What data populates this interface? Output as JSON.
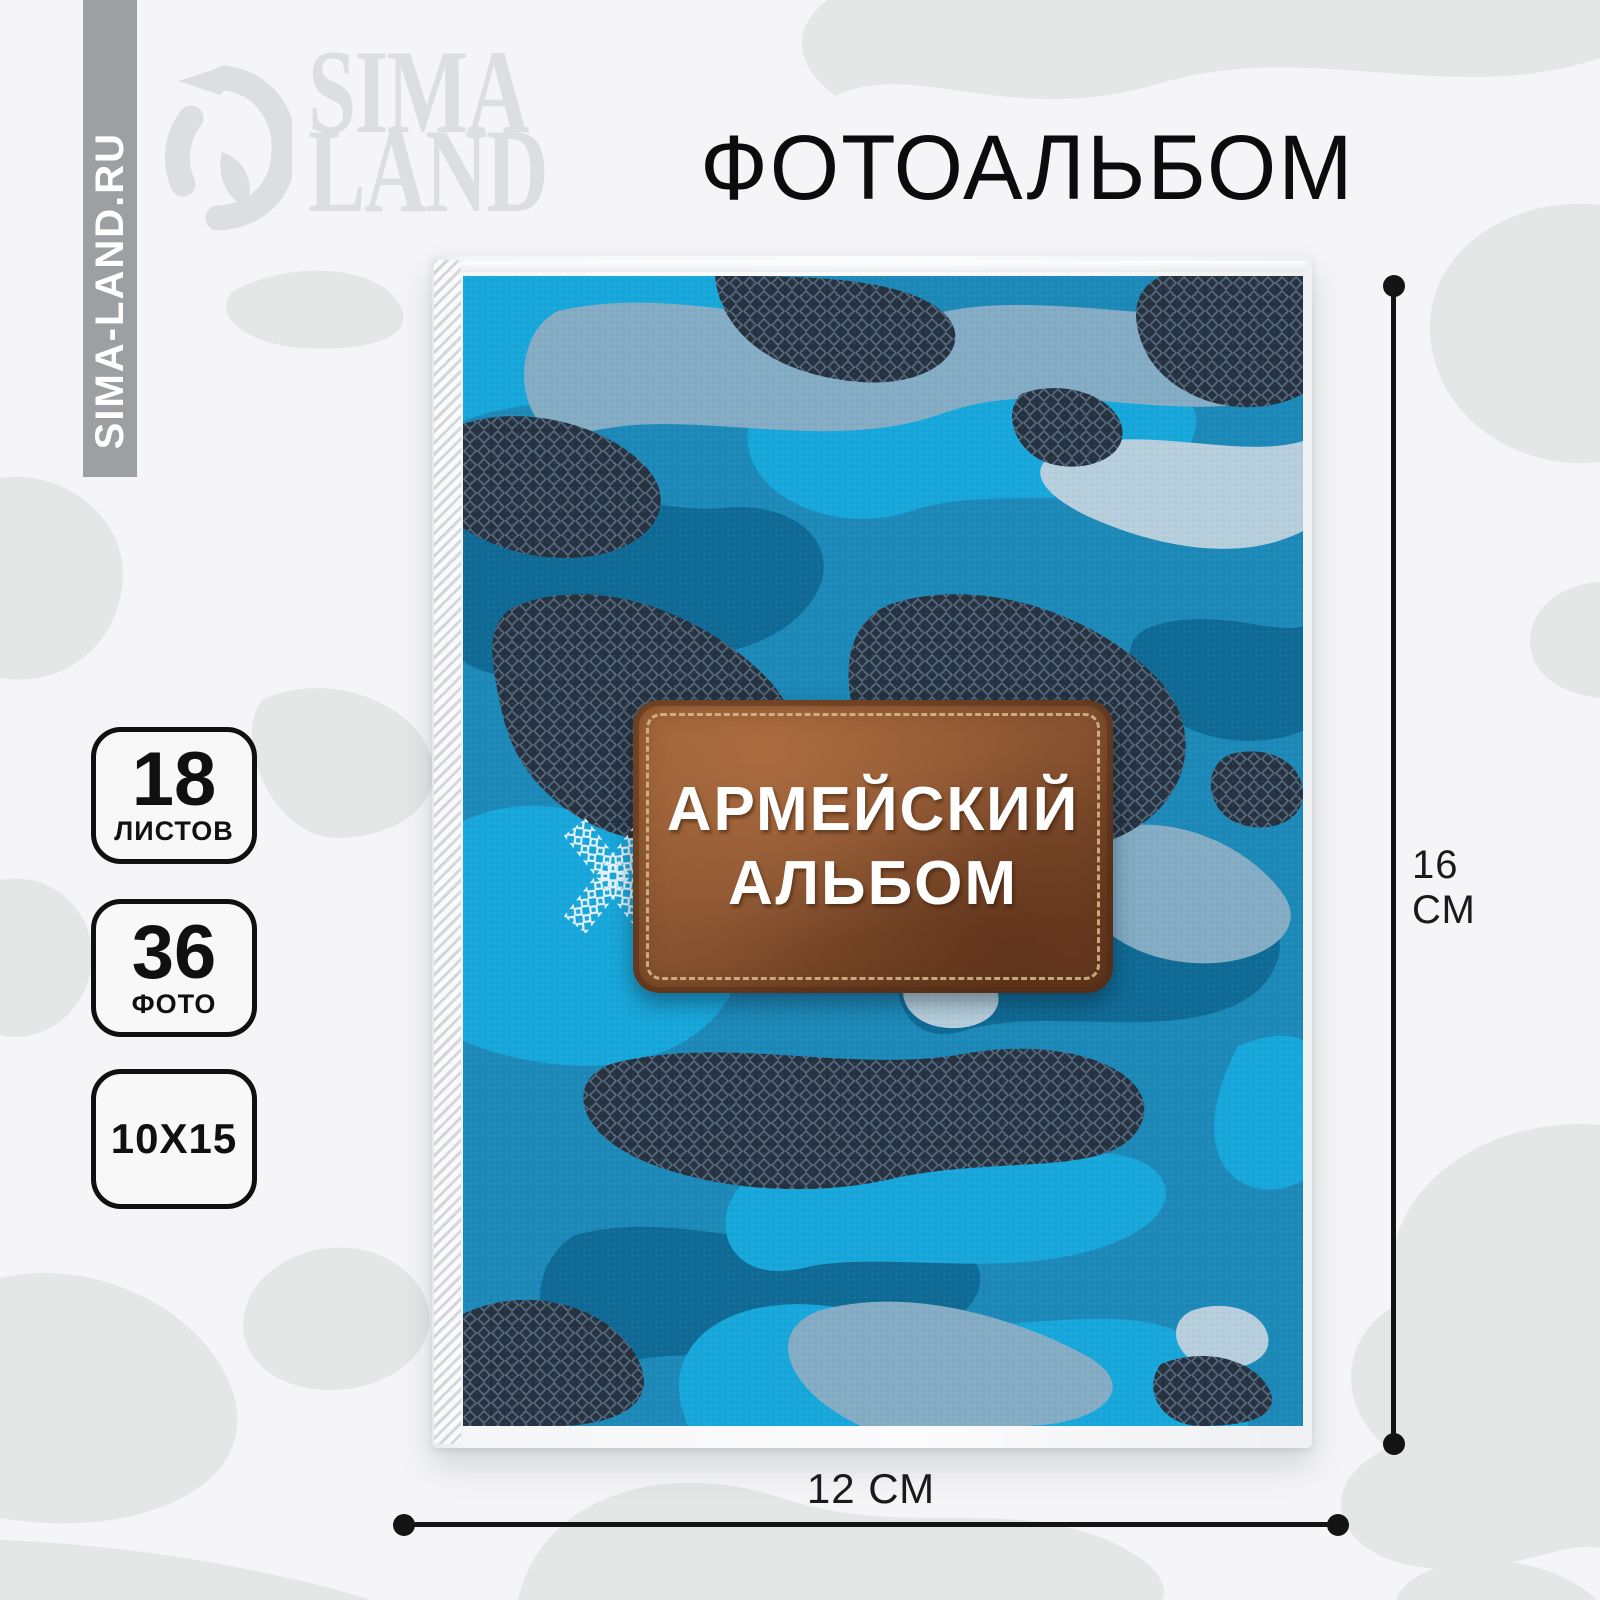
{
  "brand": {
    "logo_line1": "SIMA",
    "logo_line2": "LAND",
    "sidebar_url": "SIMA-LAND.RU"
  },
  "header": {
    "title": "ФОТОАЛЬБОМ"
  },
  "product": {
    "patch_title_line1": "АРМЕЙСКИЙ",
    "patch_title_line2": "АЛЬБОМ"
  },
  "badges": [
    {
      "value": "18",
      "label": "ЛИСТОВ"
    },
    {
      "value": "36",
      "label": "ФОТО"
    },
    {
      "value": "10X15",
      "label": ""
    }
  ],
  "dimensions": {
    "height_value": "16",
    "height_unit": "СМ",
    "width_label": "12 СМ"
  },
  "colors": {
    "page_bg": "#f5f5f7",
    "background_blob_gray": "#e4e7e6",
    "sidebar_gray": "#9da0a2",
    "watermark_gray": "#dcdee1",
    "text_black": "#111111",
    "cover_blue_base": "#1d89b8",
    "cover_blue_bright": "#18a7da",
    "cover_blue_deep": "#0f6b96",
    "cover_gray_blue": "#84adc5",
    "cover_navy_mesh": "#26323f",
    "patch_leather_brown": "#8a5532",
    "patch_stitch_tan": "#d8bd8e"
  }
}
